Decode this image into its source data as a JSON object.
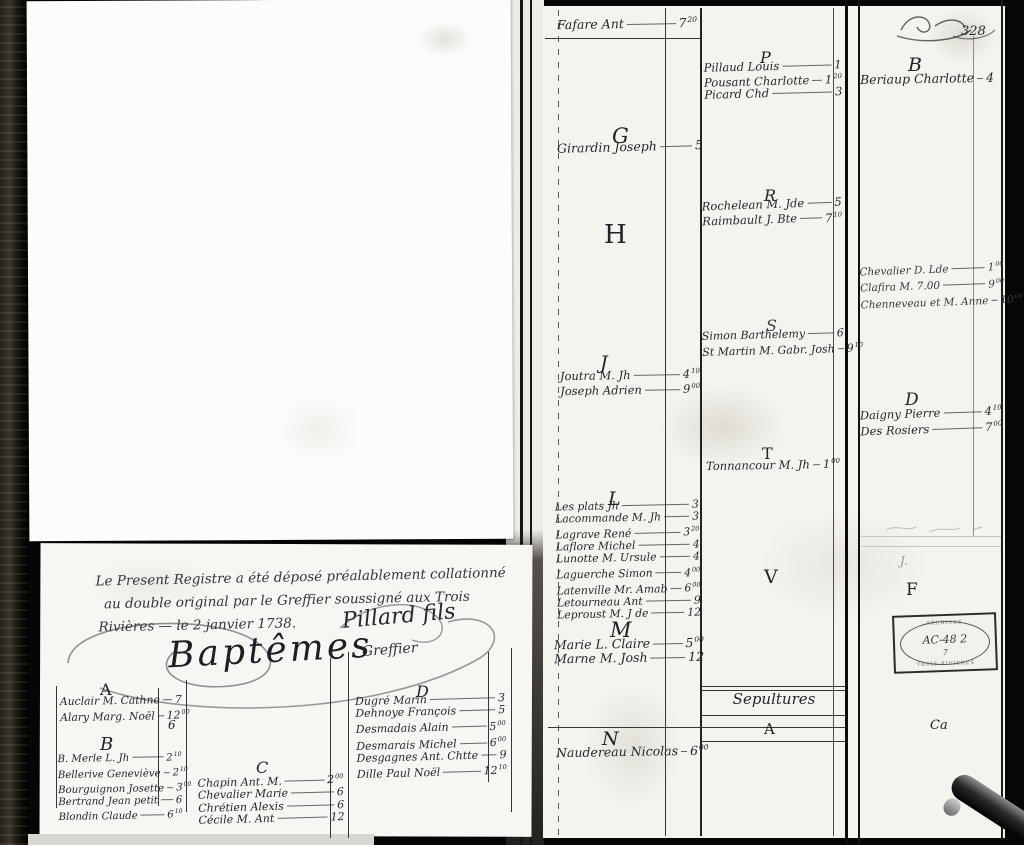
{
  "left_page": {
    "attestation": {
      "line1": "Le Present Registre a été déposé préalablement collationné",
      "line2": "au double original par le Greffier soussigné aux Trois",
      "line3": "Rivières — le 2 janvier 1738.",
      "signature": "Pillard fils",
      "signature_title": "Greffier"
    },
    "title": "Baptêmes",
    "sections": [
      {
        "letter": "A",
        "stray": "6",
        "entries": [
          {
            "name": "Auclair M. Cathne",
            "v": "7",
            "s": ""
          },
          {
            "name": "Alary Marg. Noël",
            "v": "12",
            "s": "00"
          }
        ]
      },
      {
        "letter": "B",
        "entries": [
          {
            "name": "B. Merle L. Jh",
            "v": "2",
            "s": "10"
          },
          {
            "name": "Bellerive Geneviève",
            "v": "2",
            "s": "10"
          },
          {
            "name": "Bourguignon Josette",
            "v": "3",
            "s": "00"
          },
          {
            "name": "Bertrand Jean petit",
            "v": "6",
            "s": ""
          },
          {
            "name": "Blondin Claude",
            "v": "6",
            "s": "10"
          }
        ]
      },
      {
        "letter": "C",
        "entries": [
          {
            "name": "Chapin Ant. M.",
            "v": "2",
            "s": "00"
          },
          {
            "name": "Chevalier Marie",
            "v": "6",
            "s": ""
          },
          {
            "name": "Chrétien Alexis",
            "v": "6",
            "s": ""
          },
          {
            "name": "Cécile M. Ant",
            "v": "12",
            "s": ""
          }
        ]
      },
      {
        "letter": "D",
        "entries": [
          {
            "name": "Dugré Marin",
            "v": "3",
            "s": ""
          },
          {
            "name": "Dehnoye François",
            "v": "5",
            "s": ""
          },
          {
            "name": "Desmadais Alain",
            "v": "5",
            "s": "00"
          },
          {
            "name": "Desmarais Michel",
            "v": "6",
            "s": "00"
          },
          {
            "name": "Desgagnes Ant. Chtte",
            "v": "9",
            "s": ""
          },
          {
            "name": "Dille Paul Noël",
            "v": "12",
            "s": "10"
          }
        ]
      }
    ]
  },
  "right_page": {
    "col1": {
      "sections": [
        {
          "letter": "",
          "entries": [
            {
              "name": "Fafare Ant",
              "v": "7",
              "s": "20"
            }
          ]
        },
        {
          "letter": "G",
          "entries": [
            {
              "name": "Girardin Joseph",
              "v": "5",
              "s": ""
            }
          ]
        },
        {
          "letter": "H",
          "entries": []
        },
        {
          "letter": "J",
          "entries": [
            {
              "name": "Joutra M. Jh",
              "v": "4",
              "s": "10"
            },
            {
              "name": "Joseph Adrien",
              "v": "9",
              "s": "00"
            }
          ]
        },
        {
          "letter": "L",
          "entries": [
            {
              "name": "Les plats Jh",
              "v": "3",
              "s": ""
            },
            {
              "name": "Lacommande M. Jh",
              "v": "3",
              "s": ""
            },
            {
              "name": "Lagrave René",
              "v": "3",
              "s": "20"
            },
            {
              "name": "Laflore Michel",
              "v": "4",
              "s": ""
            },
            {
              "name": "Lunotte M. Ursule",
              "v": "4",
              "s": ""
            },
            {
              "name": "Laguerche Simon",
              "v": "4",
              "s": "00"
            },
            {
              "name": "Latenville Mr. Amab",
              "v": "6",
              "s": "00"
            },
            {
              "name": "Letourneau Ant",
              "v": "9",
              "s": ""
            },
            {
              "name": "Leproust M. J de",
              "v": "12",
              "s": ""
            }
          ]
        },
        {
          "letter": "M",
          "entries": [
            {
              "name": "Marie L. Claire",
              "v": "5",
              "s": "00"
            },
            {
              "name": "Marne M. Josh",
              "v": "12",
              "s": ""
            }
          ]
        },
        {
          "letter": "N",
          "entries": [
            {
              "name": "Naudereau Nicolas",
              "v": "6",
              "s": "00"
            }
          ]
        }
      ]
    },
    "col2": {
      "sections": [
        {
          "letter": "P",
          "entries": [
            {
              "name": "Pillaud Louis",
              "v": "1",
              "s": ""
            },
            {
              "name": "Pousant Charlotte",
              "v": "1",
              "s": "20"
            },
            {
              "name": "Picard Chd",
              "v": "3",
              "s": ""
            }
          ]
        },
        {
          "letter": "R",
          "entries": [
            {
              "name": "Rochelean M. Jde",
              "v": "5",
              "s": ""
            },
            {
              "name": "Raimbault J. Bte",
              "v": "7",
              "s": "10"
            }
          ]
        },
        {
          "letter": "S",
          "entries": [
            {
              "name": "Simon Barthelemy",
              "v": "6",
              "s": ""
            },
            {
              "name": "St Martin M. Gabr. Josh",
              "v": "9",
              "s": "10"
            }
          ]
        },
        {
          "letter": "T",
          "entries": [
            {
              "name": "Tonnancour M. Jh",
              "v": "1",
              "s": "00"
            }
          ]
        },
        {
          "letter": "V",
          "entries": []
        }
      ],
      "sepultures": {
        "title": "Sepultures",
        "letter": "A"
      }
    },
    "col3": {
      "page_number": "328",
      "sections": [
        {
          "letter": "B",
          "entries": [
            {
              "name": "Beriaup Charlotte",
              "v": "4",
              "s": ""
            }
          ]
        },
        {
          "letter": "",
          "entries": [
            {
              "name": "Chevalier D. Lde",
              "v": "1",
              "s": "00"
            },
            {
              "name": "Clafira M. 7.00",
              "v": "9",
              "s": "00"
            },
            {
              "name": "Chenneveau et M. Anne",
              "v": "10",
              "s": "00"
            }
          ]
        },
        {
          "letter": "D",
          "entries": [
            {
              "name": "Daigny Pierre",
              "v": "4",
              "s": "10"
            },
            {
              "name": "Des Rosiers",
              "v": "7",
              "s": "00"
            }
          ]
        },
        {
          "letter": "F",
          "entries": []
        }
      ],
      "marks": {
        "j": "J.",
        "ca": "Ca"
      },
      "stamp": {
        "top": "ARCHIVES",
        "code": "AC-48 2",
        "sub": "7",
        "bottom": "TROIS-RIVIERES"
      }
    }
  }
}
